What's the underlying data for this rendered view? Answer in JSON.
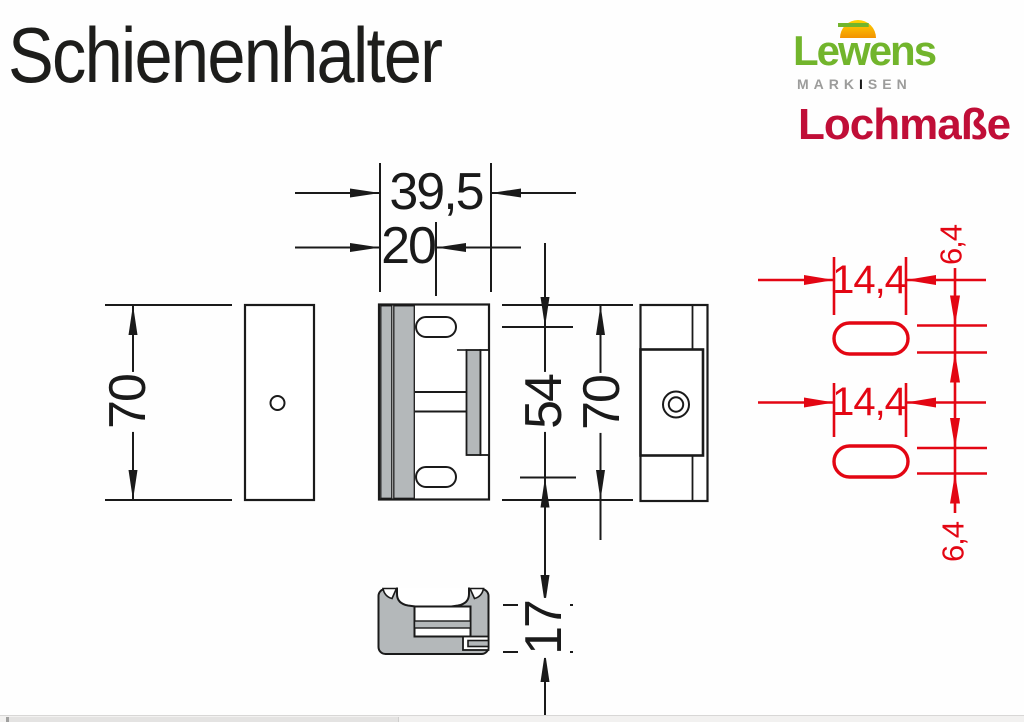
{
  "title": "Schienenhalter",
  "logo": {
    "brand_prefix": "Le",
    "brand_w": "w",
    "brand_suffix": "ens",
    "subtitle_prefix": "MARK",
    "subtitle_accent": "I",
    "subtitle_suffix": "SEN"
  },
  "heading": {
    "label": "Lochmaße"
  },
  "colors": {
    "drawing_black": "#1a1a1a",
    "drawing_red": "#e30613",
    "heading_red": "#c00e37",
    "brand_green": "#72b52c",
    "metal_gray": "#b4b8ba"
  },
  "dimensions": {
    "overall_width": "39,5",
    "hole_offset": "20",
    "left_height": "70",
    "slot_spacing": "54",
    "right_height": "70",
    "clamp_height": "17",
    "slot_width_top": "14,4",
    "slot_width_bottom": "14,4",
    "slot_height_top": "6,4",
    "slot_height_bottom": "6,4"
  }
}
